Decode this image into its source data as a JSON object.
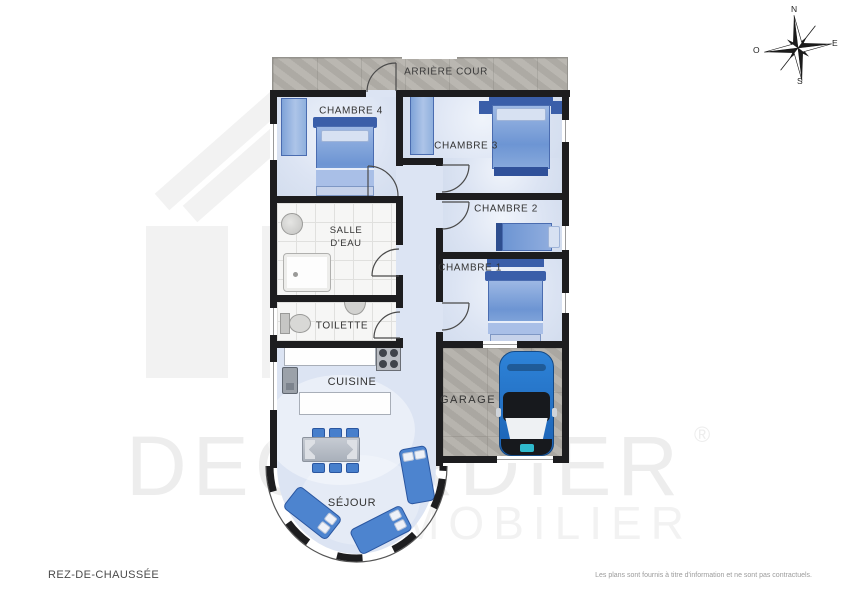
{
  "page": {
    "background": "#ffffff"
  },
  "footer": {
    "floor_label": "REZ-DE-CHAUSSÉE",
    "disclaimer": "Les plans sont fournis à titre d'information et ne sont pas contractuels."
  },
  "watermark": {
    "brand": "DECORDIER",
    "registered": "®",
    "tagline": "IMMOBILIER"
  },
  "compass": {
    "north": "N",
    "east": "E",
    "south": "S",
    "west": "O"
  },
  "rooms": [
    {
      "id": "arriere-cour",
      "label": "ARRIÈRE COUR"
    },
    {
      "id": "chambre-4",
      "label": "CHAMBRE 4"
    },
    {
      "id": "chambre-3",
      "label": "CHAMBRE 3"
    },
    {
      "id": "chambre-2",
      "label": "CHAMBRE 2"
    },
    {
      "id": "chambre-1",
      "label": "CHAMBRE 1"
    },
    {
      "id": "salle-deau",
      "label": "SALLE D'EAU",
      "line1": "SALLE",
      "line2": "D'EAU"
    },
    {
      "id": "toilette",
      "label": "TOILETTE"
    },
    {
      "id": "cuisine",
      "label": "CUISINE"
    },
    {
      "id": "garage",
      "label": "GARAGE"
    },
    {
      "id": "sejour",
      "label": "SÉJOUR"
    }
  ],
  "colors": {
    "wall": "#1d1d1f",
    "floor_blue": "#dce4f3",
    "tile_white": "#f6f6f5",
    "concrete": "#b6b3ad",
    "furniture_blue": "#4d84cf",
    "bed_blue": "#6d95d3",
    "headboard_blue": "#3a5ea9",
    "car_blue": "#2273c9",
    "car_logo_teal": "#2fb9cc",
    "watermark_gray": "#ededed",
    "label_text": "#333333"
  }
}
